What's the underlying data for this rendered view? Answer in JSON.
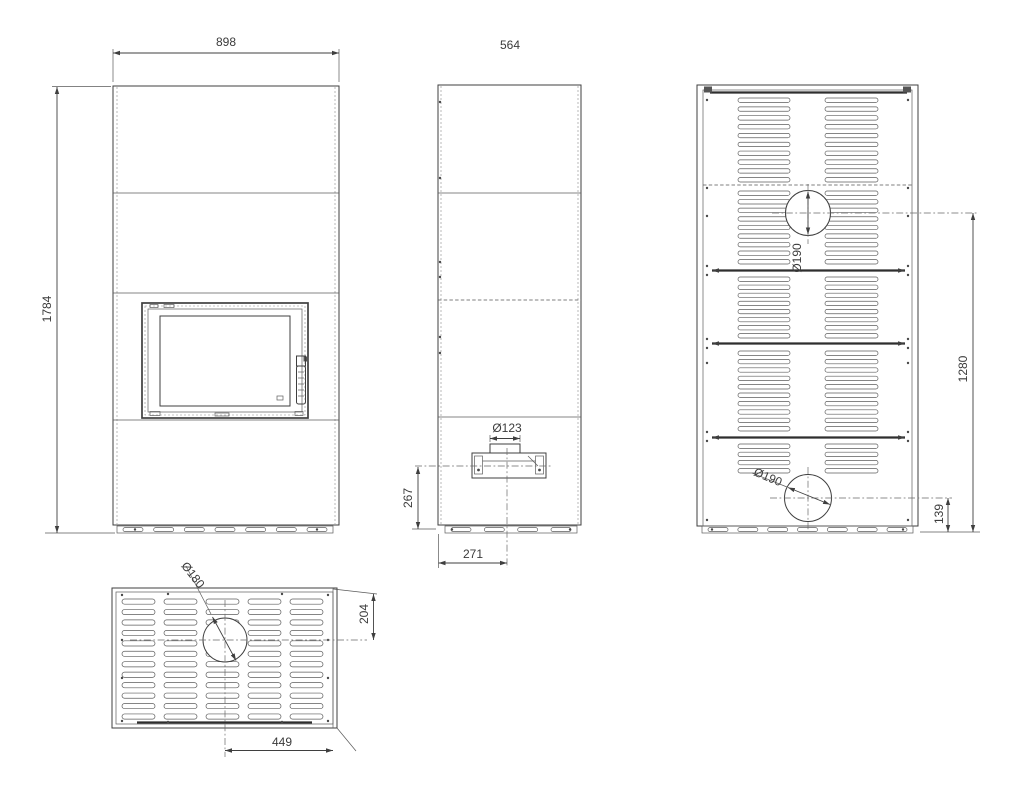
{
  "colors": {
    "background": "#ffffff",
    "line": "#3f3f3f",
    "text": "#3b3b3b"
  },
  "dimensions": {
    "front_width": "898",
    "front_height": "1784",
    "side_depth": "564",
    "side_flue_diameter": "Ø123",
    "side_flue_center_height": "267",
    "side_flue_center_from_front": "271",
    "back_upper_outlet_diameter": "Ø190",
    "back_upper_outlet_center_height": "1280",
    "back_lower_outlet_diameter": "Ø190",
    "back_lower_outlet_center_height": "139",
    "top_outlet_diameter": "Ø180",
    "top_outlet_center_from_rear": "204",
    "top_outlet_center_from_side": "449"
  }
}
